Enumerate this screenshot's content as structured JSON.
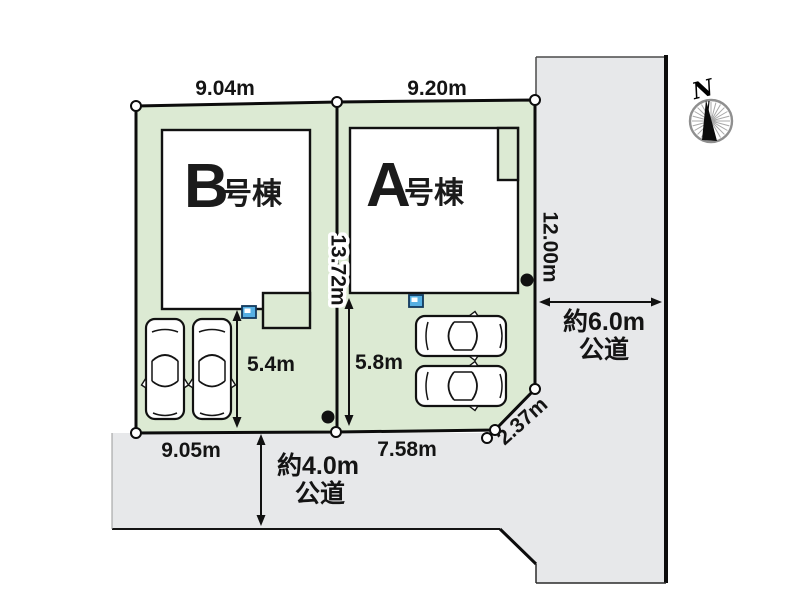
{
  "site_plan": {
    "north": "N",
    "buildings": {
      "b": {
        "letter": "B",
        "suffix": "号棟"
      },
      "a": {
        "letter": "A",
        "suffix": "号棟"
      }
    },
    "dimensions": {
      "b_frontage": "9.04m",
      "a_frontage": "9.20m",
      "center_boundary": "13.72m",
      "east_boundary": "12.00m",
      "b_parking": "5.4m",
      "a_parking": "5.8m",
      "b_south": "9.05m",
      "a_south": "7.58m",
      "corner_cut": "2.37m"
    },
    "roads": {
      "east": {
        "width": "約6.0m",
        "type": "公道"
      },
      "south": {
        "width": "約4.0m",
        "type": "公道"
      }
    },
    "colors": {
      "lot_green": "#dcead3",
      "road_gray": "#e7e8ea",
      "line": "#141414",
      "meter_blue": "#56b0e3"
    }
  }
}
